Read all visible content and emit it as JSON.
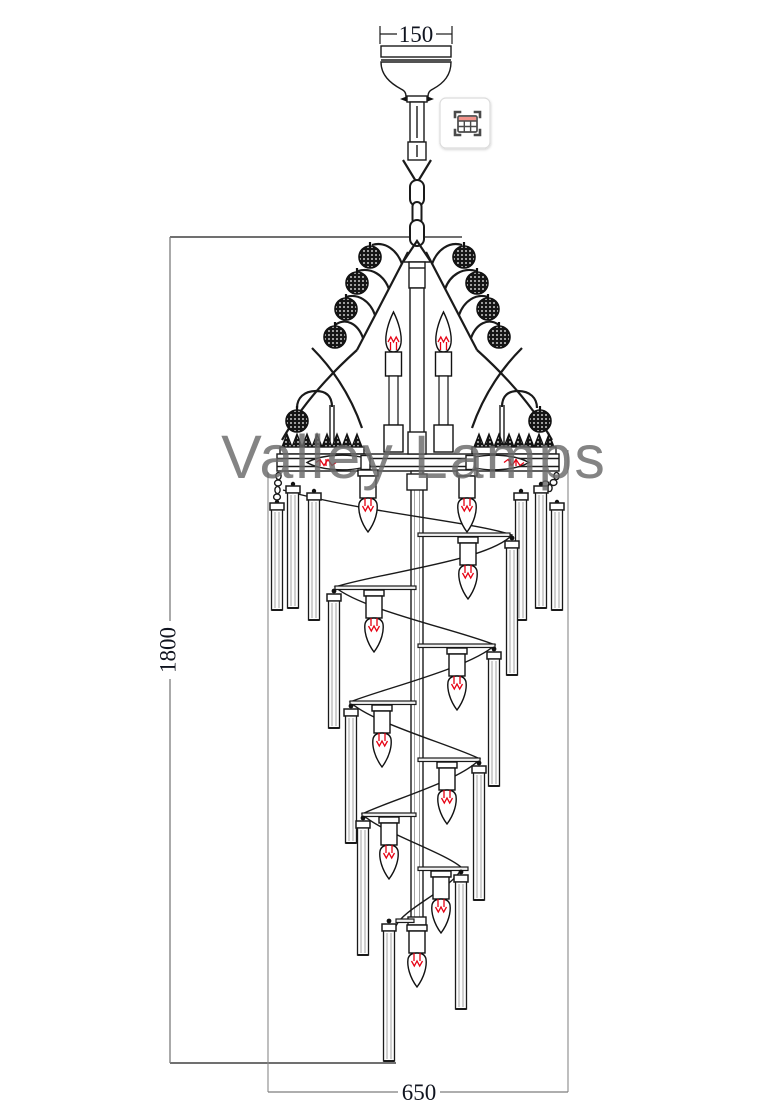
{
  "watermark": "Valley Lamps",
  "dimensions": {
    "canopy_width_mm": "150",
    "overall_height_mm": "1800",
    "fixture_width_mm": "650"
  },
  "drawing": {
    "subject": "spiral crystal chandelier technical line drawing",
    "features": [
      "ceiling canopy",
      "hanging chain",
      "crystal ball arms",
      "candle bulbs with red filaments",
      "round mounting plate with crown trim",
      "shepherd hook crystal pendants",
      "descending spiral with glass tube pendants"
    ]
  },
  "overlay_button": {
    "icon": "table-capture-icon"
  },
  "colors": {
    "line": "#1a1a1a",
    "dimension_line": "#7d7d7d",
    "dimension_text": "#10141f",
    "filament_red": "#e60012",
    "watermark_gray": "#6a6a6a",
    "icon_accent": "#f2928a"
  }
}
